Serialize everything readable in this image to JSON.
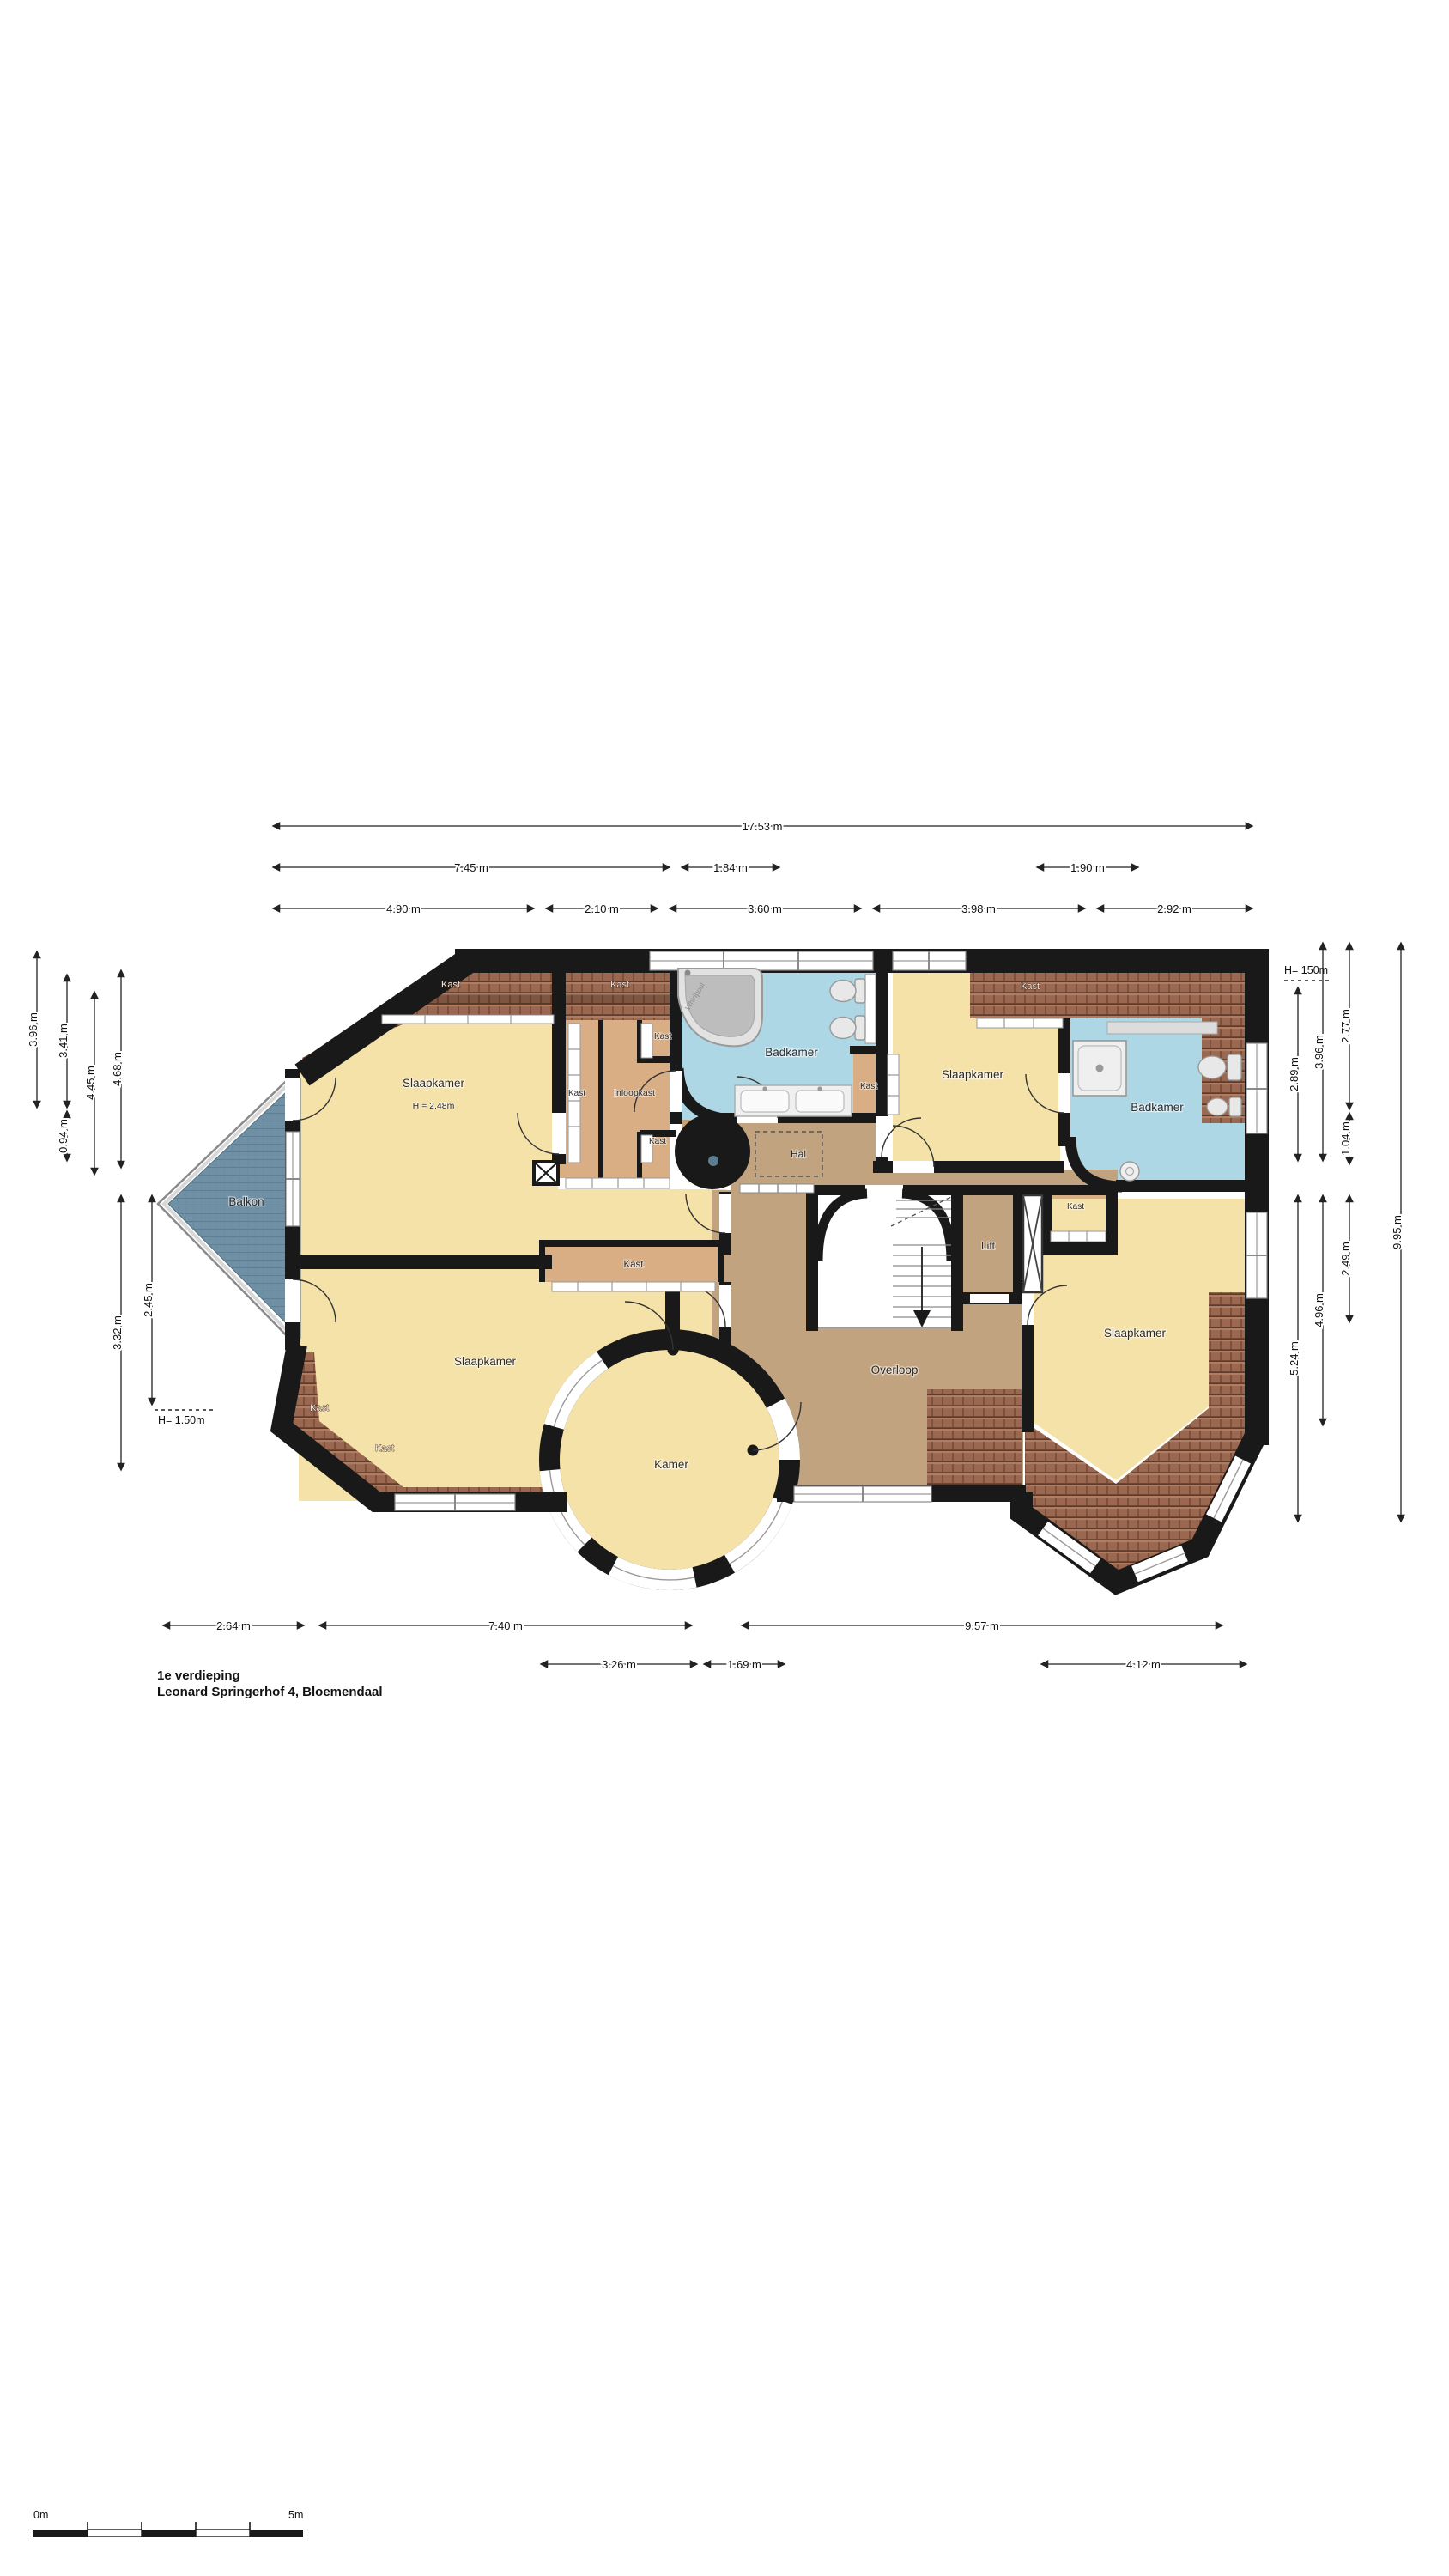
{
  "title": {
    "floor": "1e verdieping",
    "address": "Leonard Springerhof 4, Bloemendaal"
  },
  "scalebar": {
    "start": "0m",
    "end": "5m"
  },
  "notes": {
    "height_right": "H= 150m",
    "height_left": "H= 1.50m",
    "room_height_nw": "H = 2.48m",
    "bath_text": "Whirlpool"
  },
  "labels": {
    "slaapkamer": "Slaapkamer",
    "badkamer": "Badkamer",
    "kast": "Kast",
    "inloopkast": "Inloopkast",
    "hal": "Hal",
    "lift": "Lift",
    "overloop": "Overloop",
    "kamer": "Kamer",
    "balkon": "Balkon"
  },
  "dims": {
    "top_total": "17.53 m",
    "top_row2": [
      "7.45 m",
      "1.84 m",
      "1.90 m"
    ],
    "top_row3": [
      "4.90 m",
      "2.10 m",
      "3.60 m",
      "3.98 m",
      "2.92 m"
    ],
    "left": [
      "3.96 m",
      "3.41 m",
      "4.45 m",
      "4.68 m",
      "0.94 m",
      "3.32 m",
      "2.45 m"
    ],
    "right": [
      "2.89 m",
      "3.96 m",
      "2.77 m",
      "1.04 m",
      "2.49 m",
      "4.96 m",
      "5.24 m",
      "9.95 m"
    ],
    "bottom": [
      "2.64 m",
      "7.40 m",
      "9.57 m",
      "3.26 m",
      "1.69 m",
      "4.12 m"
    ]
  },
  "colors": {
    "wall": "#191919",
    "room_yellow": "#f5e2a8",
    "closet_tan": "#d9ae85",
    "landing_tan": "#c2a380",
    "bath_blue": "#aed7e6",
    "roof_brown": "#9a6850",
    "balcony_blue": "#7090a5"
  }
}
